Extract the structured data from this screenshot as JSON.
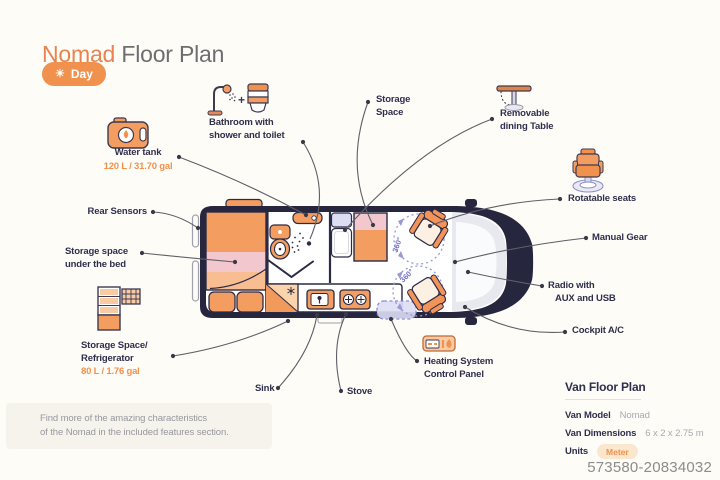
{
  "header": {
    "brand": "Nomad",
    "title": "Floor Plan",
    "day_button": "Day"
  },
  "callouts": {
    "water_tank": {
      "line1": "Water tank",
      "capacity": "120 L / 31.70 gal"
    },
    "bathroom": {
      "line1": "Bathroom with",
      "line2": "shower and toilet"
    },
    "storage_space": {
      "line1": "Storage",
      "line2": "Space"
    },
    "dining_table": {
      "line1": "Removable",
      "line2": "dining Table"
    },
    "rotatable_seats": {
      "line1": "Rotatable seats"
    },
    "manual_gear": {
      "line1": "Manual Gear"
    },
    "radio": {
      "line1": "Radio with",
      "line2": "AUX and USB"
    },
    "cockpit_ac": {
      "line1": "Cockpit A/C"
    },
    "rear_sensors": {
      "line1": "Rear Sensors"
    },
    "under_bed": {
      "line1": "Storage space",
      "line2": "under the bed"
    },
    "refrigerator": {
      "line1": "Storage Space/",
      "line2": "Refrigerator",
      "capacity": "80 L / 1.76 gal"
    },
    "sink": {
      "line1": "Sink"
    },
    "stove": {
      "line1": "Stove"
    },
    "heating": {
      "line1": "Heating System",
      "line2": "Control Panel"
    }
  },
  "diagram": {
    "rotation_label": "360°"
  },
  "note": {
    "line1": "Find more of the amazing characteristics",
    "line2": "of the Nomad in the included features section."
  },
  "spec_panel": {
    "title": "Van Floor Plan",
    "rows": [
      {
        "label": "Van Model",
        "value": "Nomad"
      },
      {
        "label": "Van Dimensions",
        "value": "6 x 2 x 2.75 m"
      },
      {
        "label": "Units",
        "value": "Meter"
      }
    ]
  },
  "watermark": "573580-20834032",
  "colors": {
    "accent": "#F0914E",
    "navy": "#26263F",
    "pink": "#F3C7CE",
    "lavender": "#DCDDF2",
    "page_bg": "#FDFCF7"
  }
}
